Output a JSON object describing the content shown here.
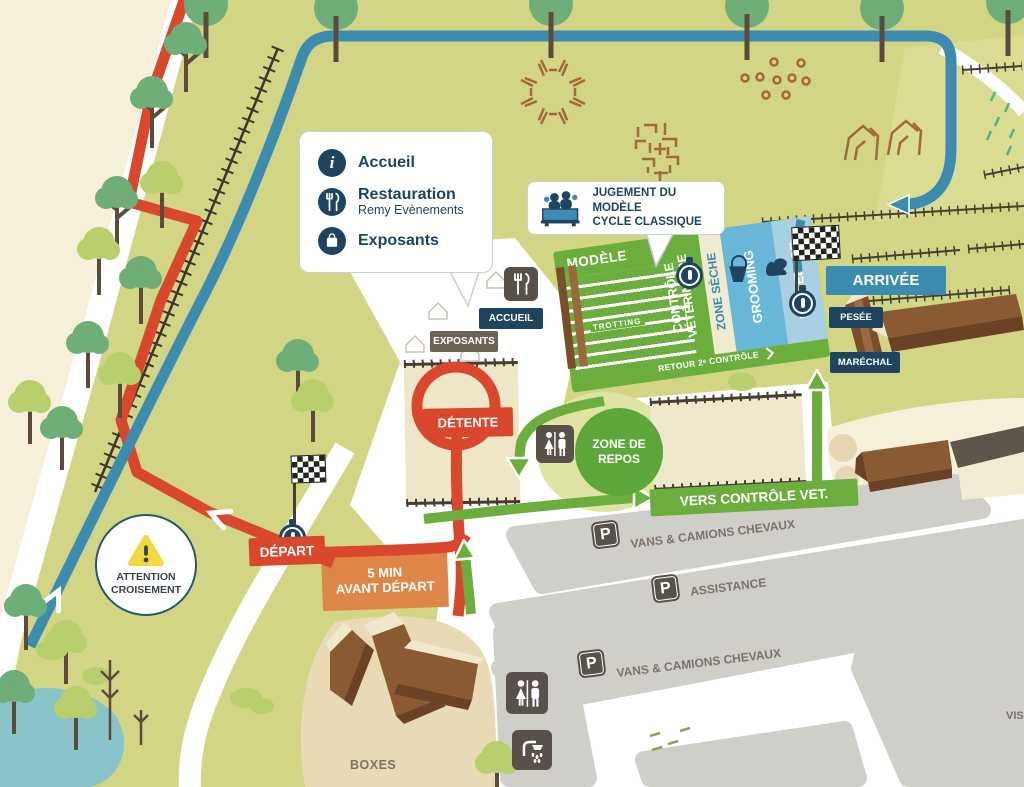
{
  "legend": {
    "items": [
      {
        "glyph": "i",
        "label": "Accueil",
        "sublabel": ""
      },
      {
        "glyph": "",
        "label": "Restauration",
        "sublabel": "Remy Evènements"
      },
      {
        "glyph": "",
        "label": "Exposants",
        "sublabel": ""
      }
    ]
  },
  "judging": {
    "line1": "JUGEMENT DU MODÈLE",
    "line2": "CYCLE CLASSIQUE"
  },
  "zones": {
    "modele": "MODÈLE",
    "trotting": "TROTTING",
    "controle_line1": "CONTRÔLE",
    "controle_line2": "VÉTÉRINAIRE",
    "zone_seche": "ZONE SÈCHE",
    "grooming": "GROOMING",
    "desselage": "DESSELAGE",
    "retour": "RETOUR 2ᵉ CONTRÔLE",
    "detente": "DÉTENTE",
    "zone_repos_line1": "ZONE DE",
    "zone_repos_line2": "REPOS",
    "vers_controle": "VERS CONTRÔLE VET."
  },
  "markers": {
    "arrivee": "ARRIVÉE",
    "pesee": "PESÉE",
    "marechal": "MARÉCHAL",
    "accueil": "ACCUEIL",
    "exposants": "EXPOSANTS",
    "depart": "DÉPART",
    "five_min_line1": "5 MIN",
    "five_min_line2": "AVANT DÉPART",
    "attention_line1": "ATTENTION",
    "attention_line2": "CROISEMENT",
    "boxes": "BOXES",
    "visiteurs_partial": "VIS"
  },
  "parking": {
    "symbol": "P",
    "row1": "VANS & CAMIONS CHEVAUX",
    "row2": "ASSISTANCE",
    "row3": "VANS & CAMIONS CHEVAUX"
  },
  "colors": {
    "route_red": "#d9482d",
    "route_blue": "#3b8cb0",
    "route_green": "#6cae3e",
    "navy": "#1e4460",
    "orange": "#de8648",
    "map_green": "#d1d584",
    "warning_yellow": "#f2d83f"
  }
}
